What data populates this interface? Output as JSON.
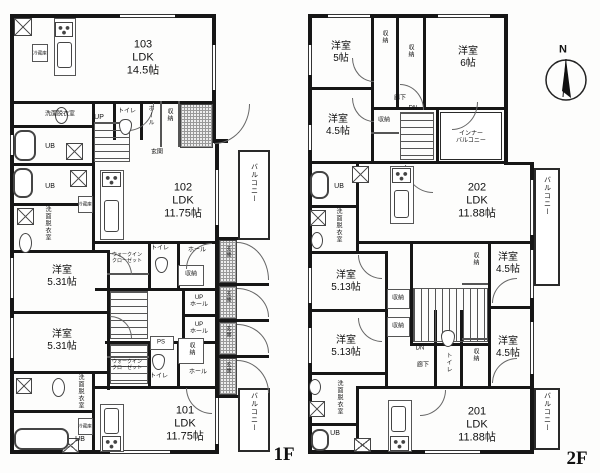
{
  "document": {
    "type": "architectural floor plan",
    "floors": [
      {
        "label": "1F",
        "units": [
          "101",
          "102",
          "103"
        ]
      },
      {
        "label": "2F",
        "units": [
          "201",
          "202"
        ]
      }
    ],
    "compass": "N",
    "colors": {
      "wall": "#161616",
      "background": "#fdfdfc",
      "line": "#555555"
    }
  },
  "units": [
    {
      "id": "103",
      "floor": "1F",
      "main_room": "LDK 14.5帖"
    },
    {
      "id": "102",
      "floor": "1F",
      "main_room": "LDK 11.75帖"
    },
    {
      "id": "101",
      "floor": "1F",
      "main_room": "LDK 11.75帖"
    },
    {
      "id": "202",
      "floor": "2F",
      "main_room": "LDK 11.88帖"
    },
    {
      "id": "201",
      "floor": "2F",
      "main_room": "LDK 11.88帖"
    }
  ],
  "texts": {
    "u103": "103\nLDK\n14.5帖",
    "u102": "102\nLDK\n11.75帖",
    "u101": "101\nLDK\n11.75帖",
    "u202": "202\nLDK\n11.88帖",
    "u201": "201\nLDK\n11.88帖",
    "yo531": "洋室\n5.31帖",
    "yo513": "洋室\n5.13帖",
    "yo45": "洋室\n4.5帖",
    "yo5": "洋室\n5帖",
    "yo6": "洋室\n6帖",
    "senmen": "洗面脱衣室",
    "ub": "UB",
    "toire": "トイレ",
    "hall": "ホール",
    "uphall": "UP\nホール",
    "up": "UP",
    "dn": "DN",
    "shuno": "収納",
    "genkan": "玄関",
    "balcony": "バルコニー",
    "innerbalcony": "インナー\nバルコニー",
    "wic": "ウォークイン\nクローゼット",
    "rouka": "廊下",
    "ps": "PS",
    "reizoko": "冷蔵庫",
    "f1": "1F",
    "f2": "2F",
    "north": "N"
  }
}
